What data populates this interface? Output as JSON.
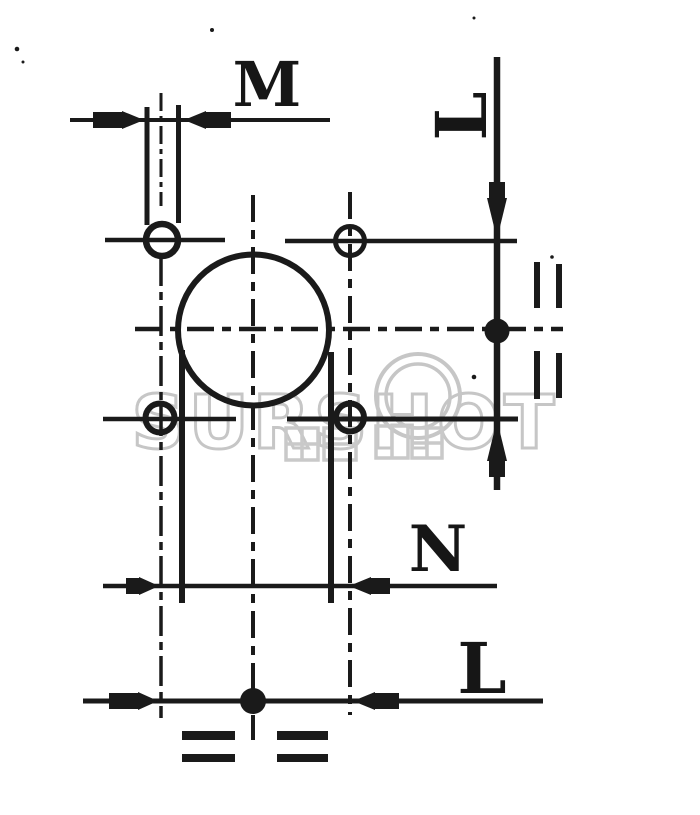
{
  "page": {
    "background_color": "#ffffff",
    "ink_color": "#1a1a1a",
    "watermark_color": "#c6c6c6"
  },
  "drawing": {
    "type": "engineering-dimension-drawing",
    "labels": {
      "slot_width_dim": "M",
      "right_vertical_dim": "L",
      "middle_horizontal_dim": "N",
      "bottom_horizontal_dim": "L"
    }
  },
  "watermark": {
    "text": "SURSHOT"
  }
}
